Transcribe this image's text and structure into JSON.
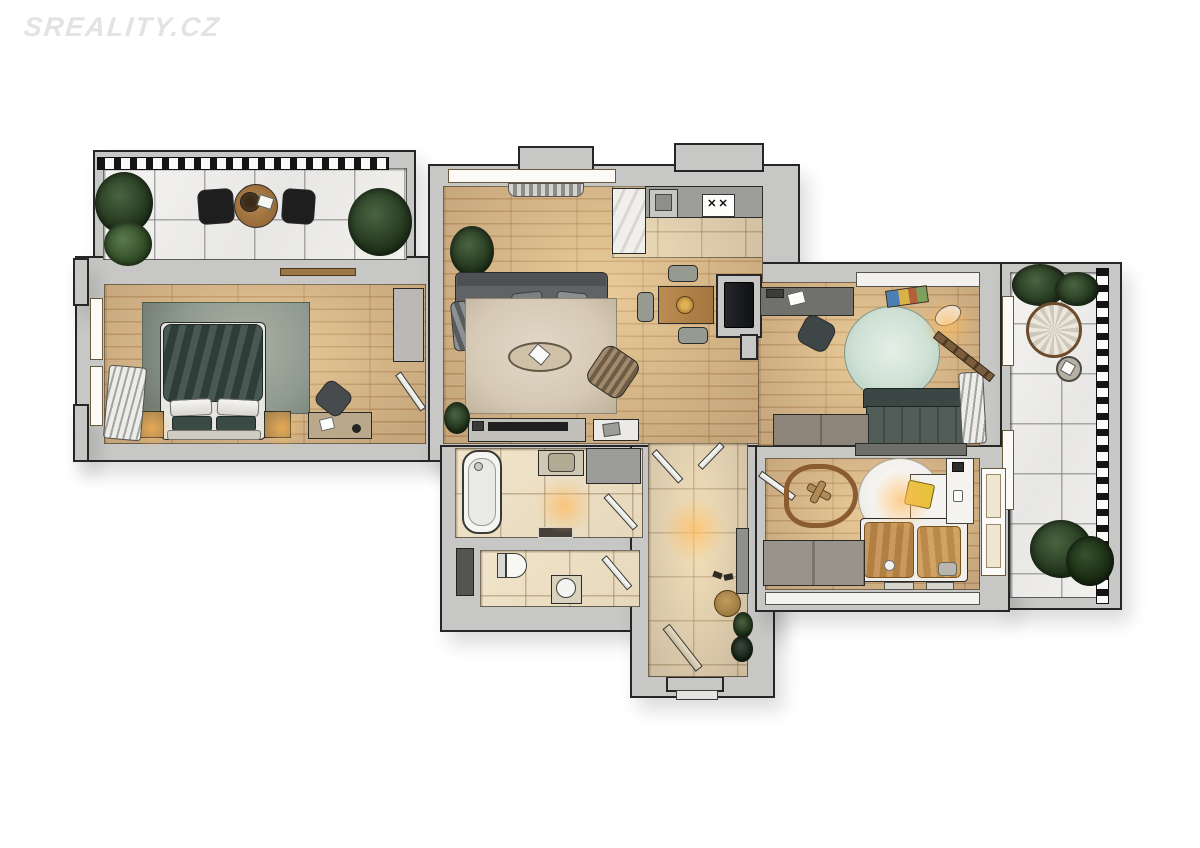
{
  "watermark": {
    "text": "SREALITY.CZ"
  },
  "scene": {
    "type": "apartment-floor-plan-3d-render-top-view",
    "rooms": [
      "terrace",
      "bedroom",
      "living-room",
      "kitchen",
      "dining-area",
      "study",
      "balcony",
      "bathroom",
      "toilet",
      "hallway",
      "kids-room",
      "entrance"
    ]
  },
  "palette": {
    "background": "#ffffff",
    "watermark": "#e3e3e3",
    "wall_fill": "#c7c7c5",
    "wall_outline": "#262626",
    "wood_floor": "#ddbd90",
    "wood_line": "#c39a6b",
    "tile_floor": "#e6d8bc",
    "marble_floor": "#f1f0ed",
    "rug_living": "#d6cab6",
    "rug_bedroom": "#8f9a8e",
    "rug_study": "#cfe0d5",
    "rug_kids": "#f3f1ed",
    "sofa_gray": "#5f6365",
    "sofa_dark": "#46534f",
    "bed_duvet": "#344540",
    "kids_bedding": "#c08a48",
    "kids_chair": "#e6c23a",
    "plant_green": "#1c2d17",
    "plant_light": "#4a6440",
    "lamp_glow": "#ffba5c"
  }
}
